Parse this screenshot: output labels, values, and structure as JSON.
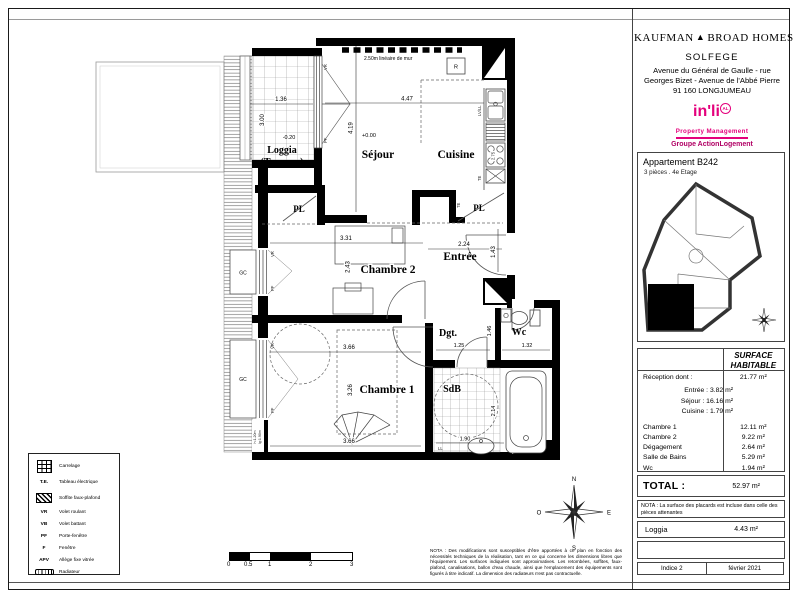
{
  "header": {
    "brand_left": "KAUFMAN",
    "brand_triangle": "▲",
    "brand_right": "BROAD HOMES",
    "project": "SOLFEGE",
    "address1": "Avenue du Général de Gaulle - rue",
    "address2": "Georges Bizet - Avenue de l'Abbé Pierre",
    "address3": "91 160 LONGJUMEAU",
    "inli": {
      "name": "in'li",
      "badge": "AL",
      "tagline": "Property Management",
      "group": "Groupe ActionLogement",
      "pink": "#e4007c",
      "dark_pink": "#b10065"
    }
  },
  "apartment": {
    "title": "Appartement B242",
    "subtitle": "3 pièces  .  4e Etage"
  },
  "surface": {
    "header1": "SURFACE",
    "header2": "HABITABLE",
    "reception_label": "Réception dont :",
    "reception_value": "21.77 m²",
    "details": [
      "Entrée :   3.82 m²",
      "Séjour :  16.16 m²",
      "Cuisine :  1.79 m²"
    ],
    "rows": [
      {
        "label": "Chambre 1",
        "value": "12.11 m²"
      },
      {
        "label": "Chambre 2",
        "value": "9.22 m²"
      },
      {
        "label": "Dégagement",
        "value": "2.64 m²"
      },
      {
        "label": "Salle de Bains",
        "value": "5.29 m²"
      },
      {
        "label": "Wc",
        "value": "1.94 m²"
      }
    ],
    "total_label": "TOTAL :",
    "total_value": "52.97 m²",
    "nota": "NOTA : La surface des placards est incluse dans celle des pièces attenantes",
    "loggia_label": "Loggia",
    "loggia_value": "4.43 m²",
    "indice": "Indice 2",
    "date": "février 2021"
  },
  "legend": {
    "items": [
      {
        "label": "Carrelage"
      },
      {
        "abbr": "T.E.",
        "label": "Tableau électrique"
      },
      {
        "label": "Soffite faux-plafond"
      },
      {
        "abbr": "VR",
        "label": "Volet roulant"
      },
      {
        "abbr": "VB",
        "label": "Volet battant"
      },
      {
        "abbr": "PF",
        "label": "Porte-fenêtre"
      },
      {
        "abbr": "F",
        "label": "Fenêtre"
      },
      {
        "abbr": "APV",
        "label": "Allège fixe vitrée"
      },
      {
        "label": "Radiateur"
      }
    ]
  },
  "scalebar": {
    "labels": [
      "0",
      "0.5",
      "1",
      "2",
      "3"
    ]
  },
  "plan": {
    "rooms": {
      "loggia1": "Loggia",
      "loggia2": "(Terrasse)",
      "sejour": "Séjour",
      "cuisine": "Cuisine",
      "chambre2": "Chambre 2",
      "chambre1": "Chambre 1",
      "entree": "Entrée",
      "dgt": "Dgt.",
      "wc": "Wc",
      "sdb": "SdB",
      "pl": "PL"
    },
    "levels": {
      "sejour": "+0.00",
      "loggia": "-0.20"
    },
    "mur": "2.50m linéaire de mur",
    "dims": {
      "loggia_w": "1.36",
      "loggia_h": "3.00",
      "sejour_w": "4.47",
      "sejour_h": "4.19",
      "cuisine_h": "2.75",
      "ch2_w": "3.31",
      "ch2_h": "2.43",
      "entree_w": "2.24",
      "entree_h": "1.43",
      "ch1_w": "3.66",
      "ch1_h": "3.26",
      "ch1_w_b": "3.66",
      "dgt_w": "1.25",
      "wc_w": "1.32",
      "wc_h": "1.46",
      "sdb_w": "1.90",
      "sdb_h": "2.14"
    },
    "tags": {
      "vr": "VR",
      "pf": "PF",
      "gc": "GC",
      "te": "TE",
      "ll": "LL",
      "lvll": "LV/LL",
      "r": "R"
    },
    "window_note1": "h:1.20m",
    "window_note2": "lg:1.90m",
    "compass": {
      "n": "N",
      "s": "S",
      "e": "E",
      "o": "O"
    }
  },
  "nota_plan": "NOTA : Des modifications sont susceptibles d'être apportées à ce plan en fonction des nécessités techniques de la réalisation, tant en ce qui concerne les dimensions libres que l'équipement. Les surfaces indiquées sont approximatives. Les retombées, soffites, faux-plafond, canalisations, ballon d'eau chaude, ainsi que l'emplacement des équipements sont figurés à titre indicatif. La dimension des radiateurs n'est pas contractuelle."
}
